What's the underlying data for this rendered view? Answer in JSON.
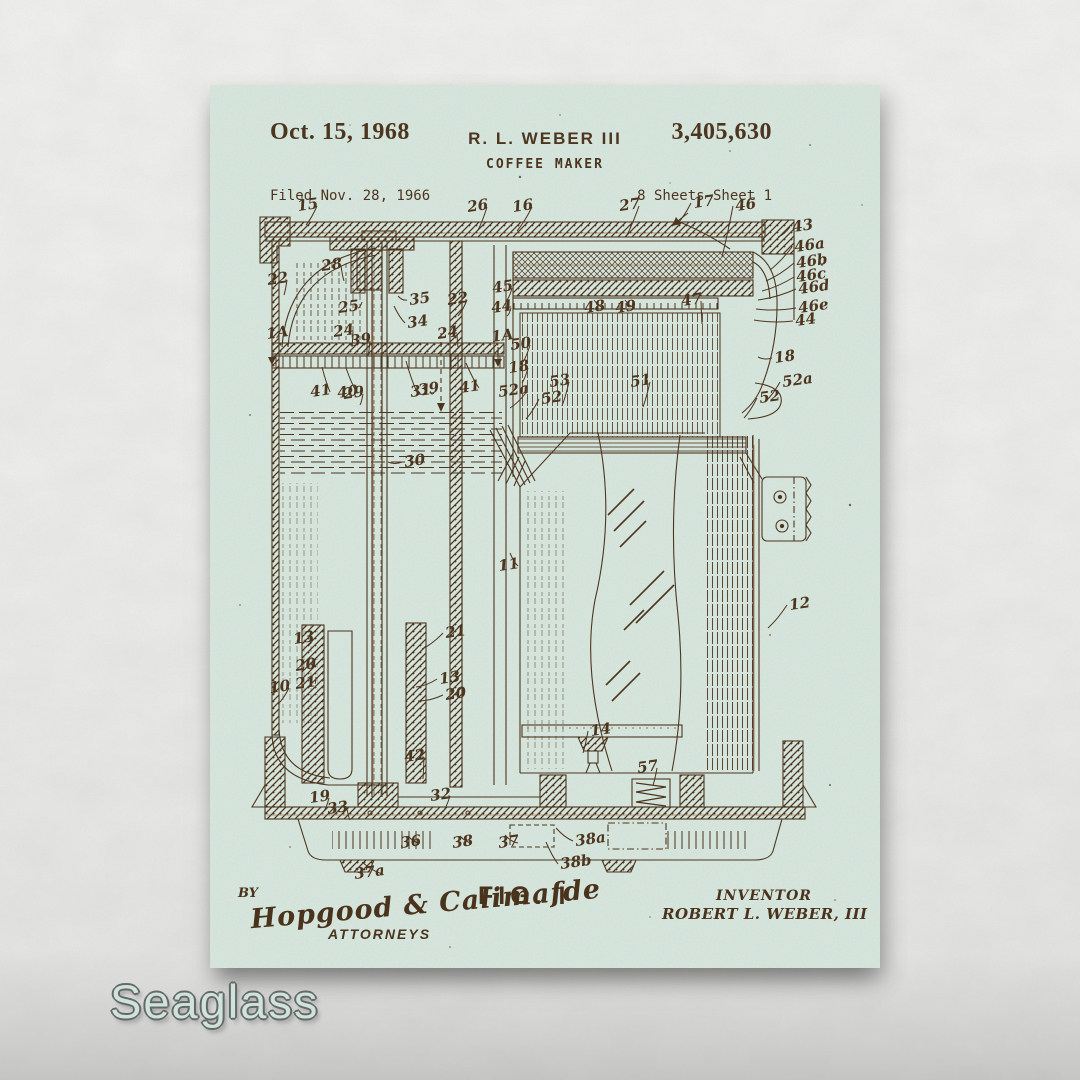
{
  "wall_color": "#efefed",
  "poster": {
    "paper_color": "#d7e7df",
    "ink_color": "#4a331d",
    "rust_color": "#8a5530",
    "header": {
      "date": "Oct. 15, 1968",
      "inventor_line": "R. L. WEBER III",
      "title": "COFFEE MAKER",
      "patent_number": "3,405,630",
      "filed": "Filed Nov. 28, 1966",
      "sheets": "8 Sheets-Sheet 1"
    },
    "figure_label": "FIG. I",
    "footer": {
      "by": "BY",
      "signature": "Hopgood & Calimafde",
      "attorneys": "ATTORNEYS",
      "inventor_caption": "INVENTOR",
      "inventor_name": "ROBERT L. WEBER, III"
    },
    "reference_labels": [
      [
        "15",
        88,
        126,
        96,
        140
      ],
      [
        "26",
        258,
        127,
        268,
        145
      ],
      [
        "16",
        303,
        127,
        307,
        146
      ],
      [
        "27",
        410,
        126,
        416,
        152
      ],
      [
        "17",
        484,
        123,
        468,
        138
      ],
      [
        "46",
        526,
        126,
        512,
        172
      ],
      [
        "43",
        583,
        147,
        568,
        152
      ],
      [
        "46a",
        585,
        167,
        560,
        185
      ],
      [
        "46b",
        587,
        183,
        556,
        196
      ],
      [
        "46c",
        587,
        197,
        552,
        206
      ],
      [
        "46d",
        589,
        209,
        548,
        215
      ],
      [
        "46e",
        589,
        228,
        546,
        224
      ],
      [
        "44",
        586,
        241,
        544,
        235
      ],
      [
        "22",
        58,
        200,
        74,
        210
      ],
      [
        "28",
        112,
        186,
        134,
        196
      ],
      [
        "25",
        129,
        228,
        152,
        217
      ],
      [
        "35",
        200,
        220,
        188,
        211
      ],
      [
        "34",
        198,
        243,
        184,
        221
      ],
      [
        "22",
        238,
        220,
        248,
        231
      ],
      [
        "45",
        283,
        208,
        297,
        215
      ],
      [
        "44",
        282,
        228,
        297,
        231
      ],
      [
        "24",
        124,
        252,
        142,
        262
      ],
      [
        "39",
        141,
        261,
        158,
        271
      ],
      [
        "24",
        228,
        254,
        248,
        262
      ],
      [
        "1A",
        282,
        257,
        null,
        null
      ],
      [
        "50",
        301,
        265,
        313,
        277
      ],
      [
        "18",
        299,
        288,
        312,
        298
      ],
      [
        "48",
        375,
        228,
        384,
        215
      ],
      [
        "49",
        406,
        228,
        415,
        215
      ],
      [
        "47",
        472,
        221,
        492,
        239
      ],
      [
        "1A",
        57,
        254,
        null,
        null
      ],
      [
        "41",
        101,
        312,
        112,
        282
      ],
      [
        "40",
        128,
        313,
        136,
        283
      ],
      [
        "39",
        209,
        310,
        196,
        276
      ],
      [
        "41",
        250,
        308,
        256,
        278
      ],
      [
        "52a",
        289,
        312,
        300,
        323
      ],
      [
        "53",
        340,
        302,
        352,
        321
      ],
      [
        "51",
        421,
        302,
        433,
        322
      ],
      [
        "52a",
        573,
        302,
        556,
        316
      ],
      [
        "18",
        565,
        278,
        548,
        272
      ],
      [
        "29",
        134,
        314,
        150,
        320
      ],
      [
        "31",
        201,
        312,
        224,
        308
      ],
      [
        "52",
        332,
        319,
        316,
        334
      ],
      [
        "52",
        550,
        318,
        534,
        333
      ],
      [
        "30",
        195,
        382,
        178,
        377
      ],
      [
        "11",
        289,
        486,
        300,
        468
      ],
      [
        "12",
        580,
        525,
        558,
        543
      ],
      [
        "13",
        84,
        559,
        98,
        560
      ],
      [
        "20",
        86,
        586,
        101,
        578
      ],
      [
        "21",
        86,
        604,
        106,
        592
      ],
      [
        "10",
        60,
        608,
        68,
        619
      ],
      [
        "21",
        236,
        553,
        212,
        564
      ],
      [
        "13",
        230,
        599,
        206,
        602
      ],
      [
        "20",
        236,
        615,
        208,
        616
      ],
      [
        "42",
        195,
        677,
        213,
        694
      ],
      [
        "14",
        381,
        651,
        373,
        668
      ],
      [
        "57",
        428,
        688,
        443,
        700
      ],
      [
        "19",
        100,
        718,
        114,
        726
      ],
      [
        "33",
        118,
        729,
        140,
        735
      ],
      [
        "32",
        221,
        716,
        233,
        727
      ],
      [
        "36",
        191,
        763,
        198,
        751
      ],
      [
        "38",
        243,
        763,
        250,
        751
      ],
      [
        "37",
        289,
        763,
        295,
        750
      ],
      [
        "38a",
        366,
        761,
        346,
        743
      ],
      [
        "38b",
        351,
        784,
        336,
        757
      ],
      [
        "37a",
        145,
        794,
        152,
        777
      ]
    ]
  },
  "watermark": {
    "text": "Seaglass",
    "fill": "#cfe3da",
    "outline": "#63696a"
  }
}
